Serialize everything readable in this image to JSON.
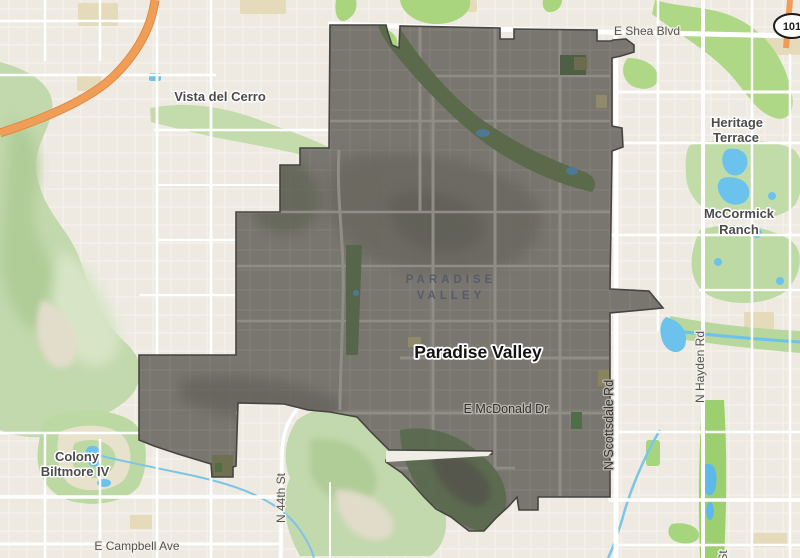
{
  "app": {
    "description": "Street map view highlighting the Town of Paradise Valley boundary"
  },
  "colors": {
    "map_background": "#eeeae2",
    "highlight_fill": "#79766f",
    "highlight_border": "#45443f",
    "park_green": "#bfd9a4",
    "bright_green": "#a9d57e",
    "water_blue": "#6bc2ec",
    "highway_orange": "#f09d57",
    "road_white": "#ffffff"
  },
  "labels": {
    "city": "Paradise Valley",
    "area_line1": "PARADISE",
    "area_line2": "VALLEY",
    "shea": "E Shea Blvd",
    "vista": "Vista del Cerro",
    "heritage_line1": "Heritage",
    "heritage_line2": "Terrace",
    "mccormick_line1": "McCormick",
    "mccormick_line2": "Ranch",
    "hayden": "N Hayden Rd",
    "scottsdale": "N Scottsdale Rd",
    "mcdonald": "E McDonald Dr",
    "fortyfourth": "N 44th St",
    "colony_line1": "Colony",
    "colony_line2": "Biltmore IV",
    "campbell": "E Campbell Ave",
    "shield": "101",
    "partial_st": "St"
  }
}
